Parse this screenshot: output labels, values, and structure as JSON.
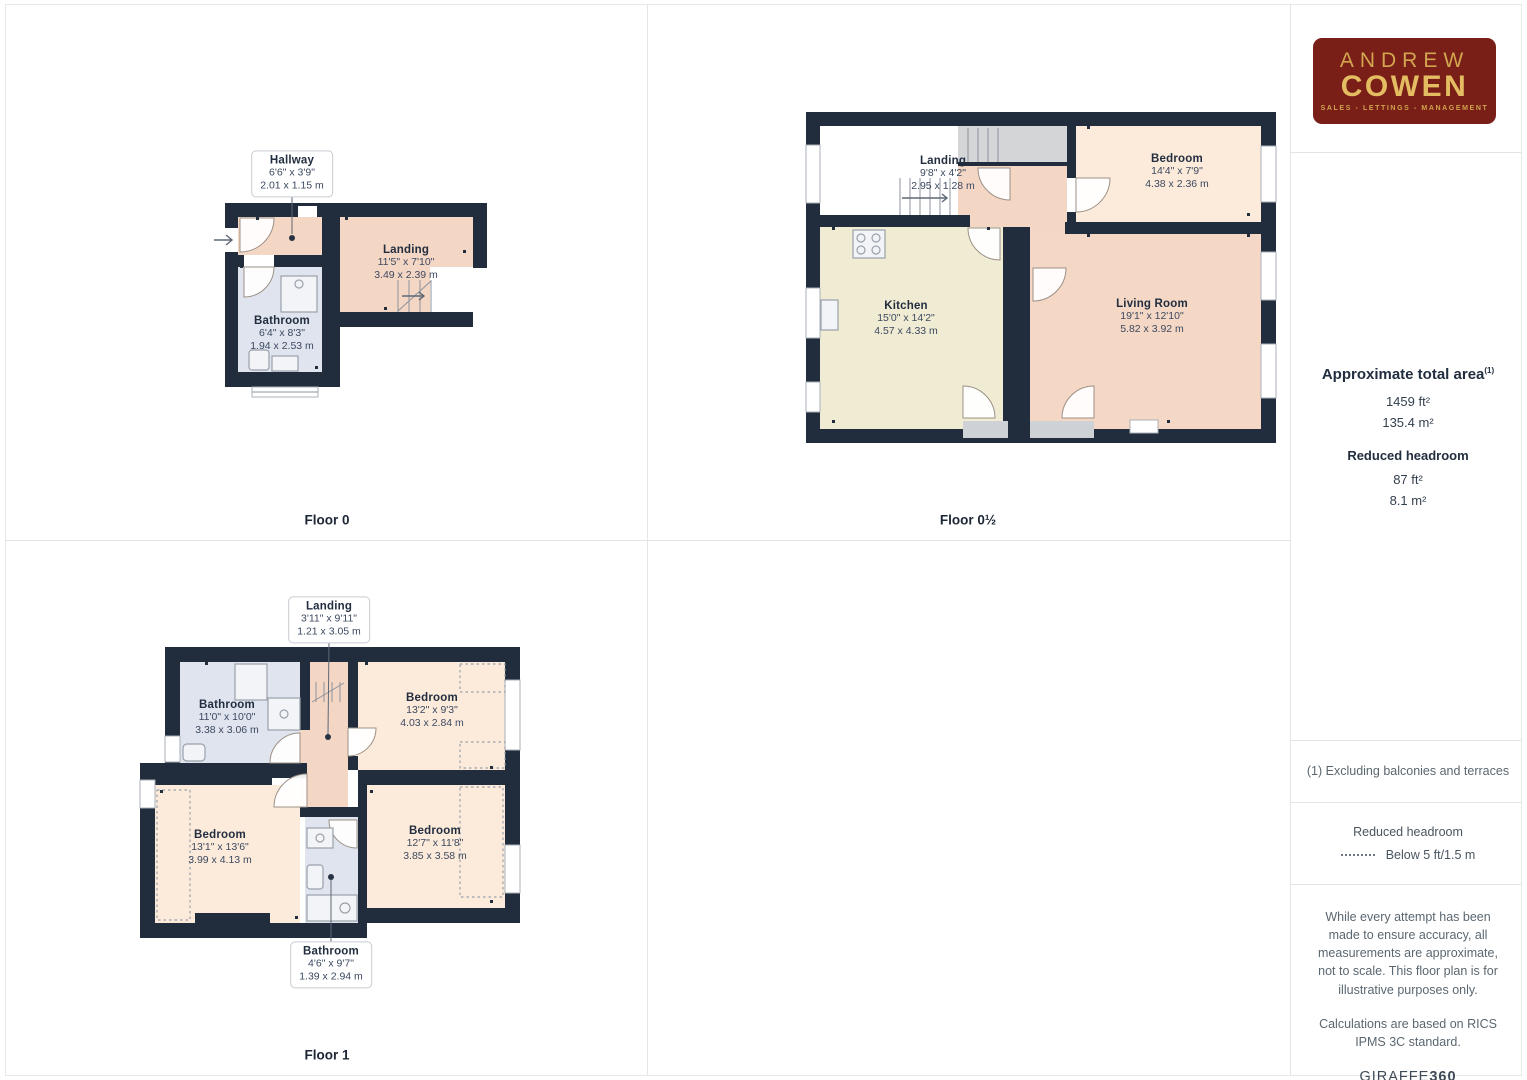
{
  "floors": {
    "f0": {
      "label": "Floor 0",
      "rooms": {
        "hallway": {
          "name": "Hallway",
          "imperial": "6'6\" x 3'9\"",
          "metric": "2.01 x 1.15 m"
        },
        "landing": {
          "name": "Landing",
          "imperial": "11'5\" x 7'10\"",
          "metric": "3.49 x 2.39 m"
        },
        "bathroom": {
          "name": "Bathroom",
          "imperial": "6'4\" x 8'3\"",
          "metric": "1.94 x 2.53 m"
        }
      }
    },
    "f0h": {
      "label": "Floor 0½",
      "rooms": {
        "landing": {
          "name": "Landing",
          "imperial": "9'8\" x 4'2\"",
          "metric": "2.95 x 1.28 m"
        },
        "bedroom": {
          "name": "Bedroom",
          "imperial": "14'4\" x 7'9\"",
          "metric": "4.38 x 2.36 m"
        },
        "kitchen": {
          "name": "Kitchen",
          "imperial": "15'0\" x 14'2\"",
          "metric": "4.57 x 4.33 m"
        },
        "living_room": {
          "name": "Living Room",
          "imperial": "19'1\" x 12'10\"",
          "metric": "5.82 x 3.92 m"
        }
      }
    },
    "f1": {
      "label": "Floor 1",
      "rooms": {
        "landing": {
          "name": "Landing",
          "imperial": "3'11\" x 9'11\"",
          "metric": "1.21 x 3.05 m"
        },
        "bathroom_top": {
          "name": "Bathroom",
          "imperial": "11'0\" x 10'0\"",
          "metric": "3.38 x 3.06 m"
        },
        "bedroom_top_right": {
          "name": "Bedroom",
          "imperial": "13'2\" x 9'3\"",
          "metric": "4.03 x 2.84 m"
        },
        "bedroom_bottom_left": {
          "name": "Bedroom",
          "imperial": "13'1\" x 13'6\"",
          "metric": "3.99 x 4.13 m"
        },
        "bedroom_bottom_right": {
          "name": "Bedroom",
          "imperial": "12'7\" x 11'8\"",
          "metric": "3.85 x 3.58 m"
        },
        "bathroom_bottom": {
          "name": "Bathroom",
          "imperial": "4'6\" x 9'7\"",
          "metric": "1.39 x 2.94 m"
        }
      }
    }
  },
  "sidebar": {
    "logo": {
      "line1": "ANDREW",
      "line2": "COWEN",
      "line3": "SALES - LETTINGS - MANAGEMENT"
    },
    "area": {
      "title": "Approximate total area",
      "superscript": "(1)",
      "value_ft": "1459 ft²",
      "value_m": "135.4 m²",
      "headroom_title": "Reduced headroom",
      "headroom_ft": "87 ft²",
      "headroom_m": "8.1 m²"
    },
    "notes": {
      "exclusion": "(1) Excluding balconies and terraces",
      "legend_title": "Reduced headroom",
      "legend_value": "Below 5 ft/1.5 m",
      "disclaimer1": "While every attempt has been made to ensure accuracy, all measurements are approximate, not to scale. This floor plan is for illustrative purposes only.",
      "disclaimer2": "Calculations are based on RICS IPMS 3C standard.",
      "brand": "GIRAFFE",
      "brand_bold": "360"
    }
  },
  "colors": {
    "wall": "#212d3d",
    "hallway_landing": "#f4d6c4",
    "bedroom": "#fcebdb",
    "kitchen": "#f0ebd3",
    "living_room": "#f4d7c5",
    "bathroom": "#dfe4ef",
    "stairs": "#d4d5d7",
    "logo_background": "#7a1e18",
    "logo_gold": "#d9ae55",
    "text_dark": "#222e40"
  }
}
